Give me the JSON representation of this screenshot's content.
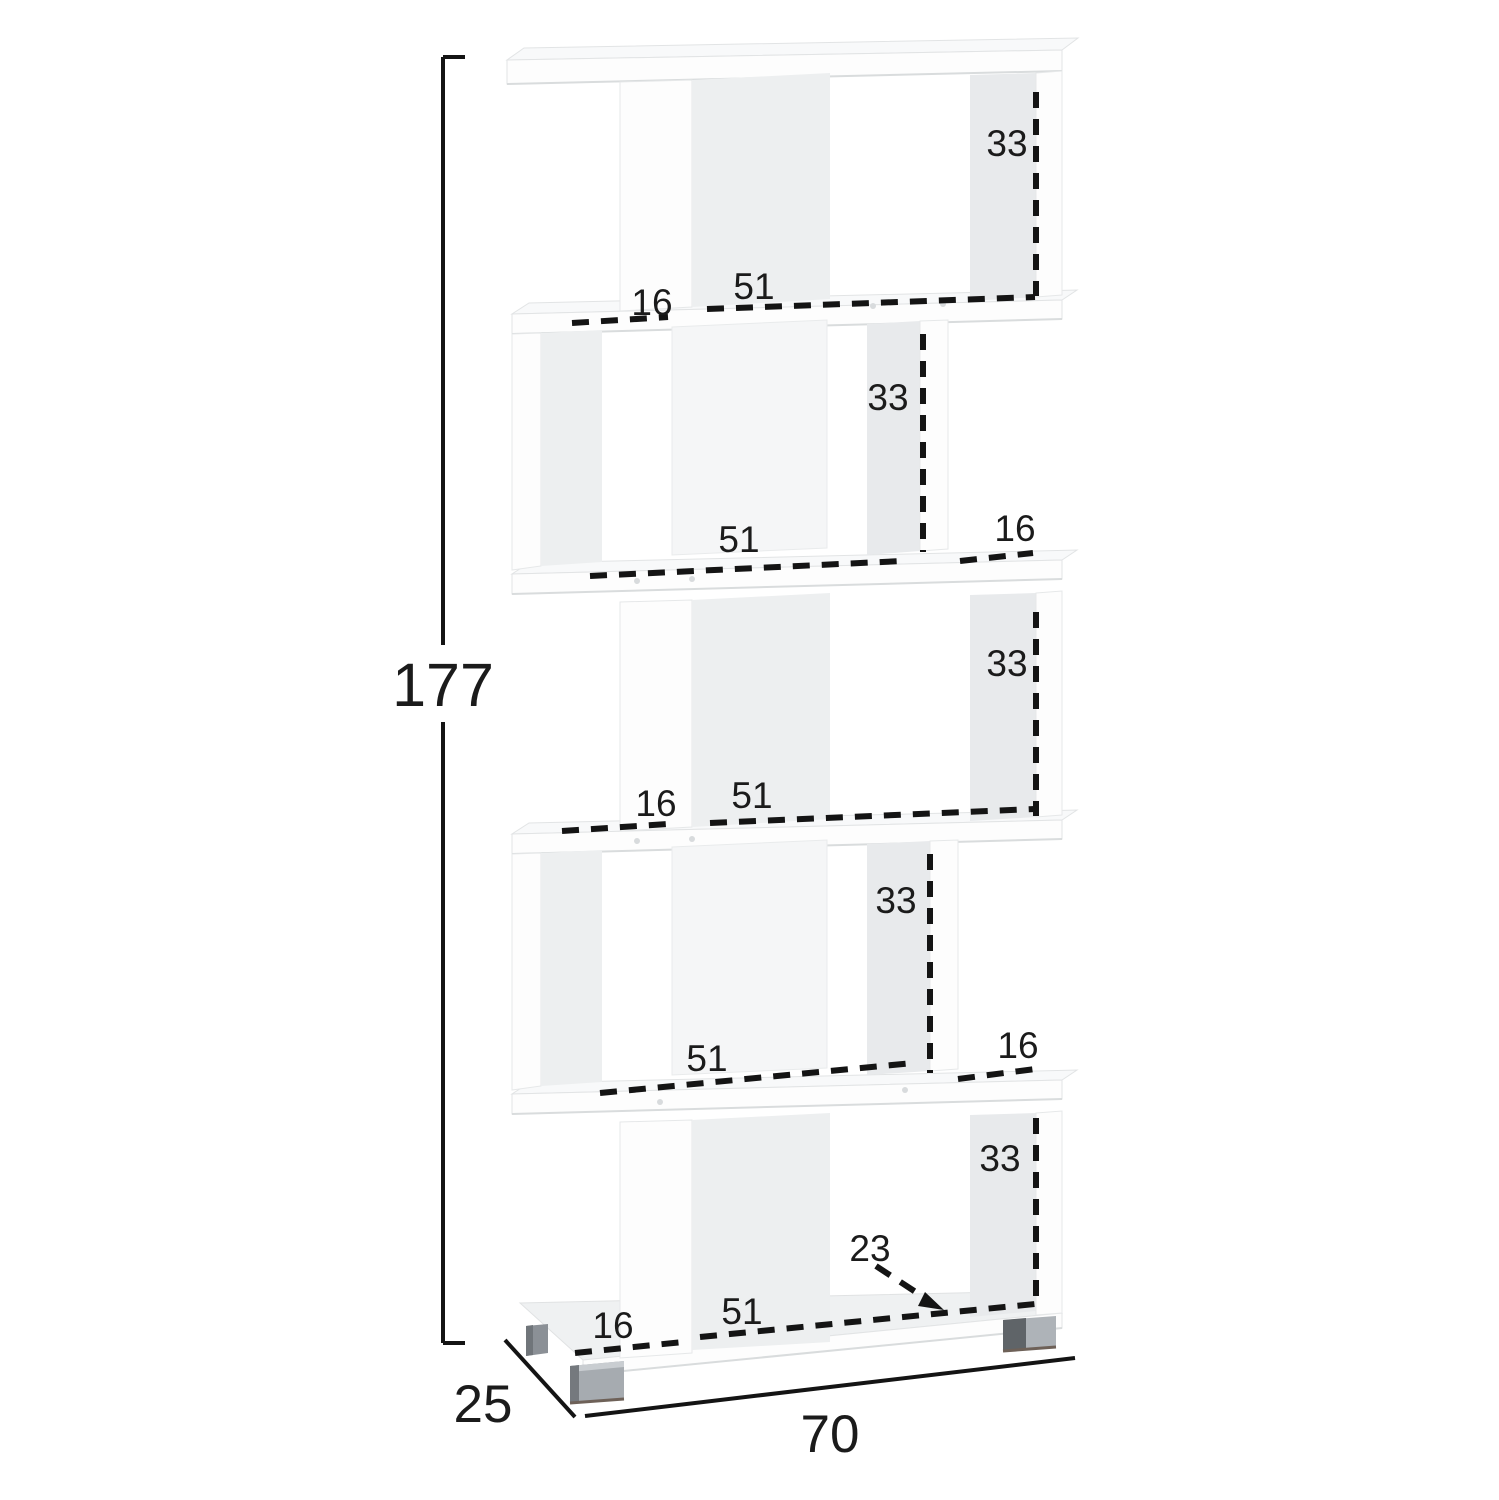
{
  "diagram": {
    "title": "5-tier zigzag bookcase dimension diagram",
    "overall": {
      "height_cm": "177",
      "depth_cm": "25",
      "width_cm": "70"
    },
    "tiers": [
      {
        "inner_height_cm": "33",
        "inner_width_cm": "51",
        "side_section_cm": "16"
      },
      {
        "inner_height_cm": "33",
        "inner_width_cm": "51",
        "side_section_cm": "16"
      },
      {
        "inner_height_cm": "33",
        "inner_width_cm": "51",
        "side_section_cm": "16"
      },
      {
        "inner_height_cm": "33",
        "inner_width_cm": "51",
        "side_section_cm": "16"
      },
      {
        "inner_height_cm": "33",
        "inner_width_cm": "51",
        "side_section_cm": "16",
        "base_depth_cm": "23"
      }
    ],
    "colors": {
      "background": "#ffffff",
      "panel_white": "#fdfdfd",
      "panel_shadow": "#e8eaec",
      "dimension_line": "#141414",
      "foot_gray": "#aeb3b8",
      "foot_dark": "#5f6468"
    }
  }
}
